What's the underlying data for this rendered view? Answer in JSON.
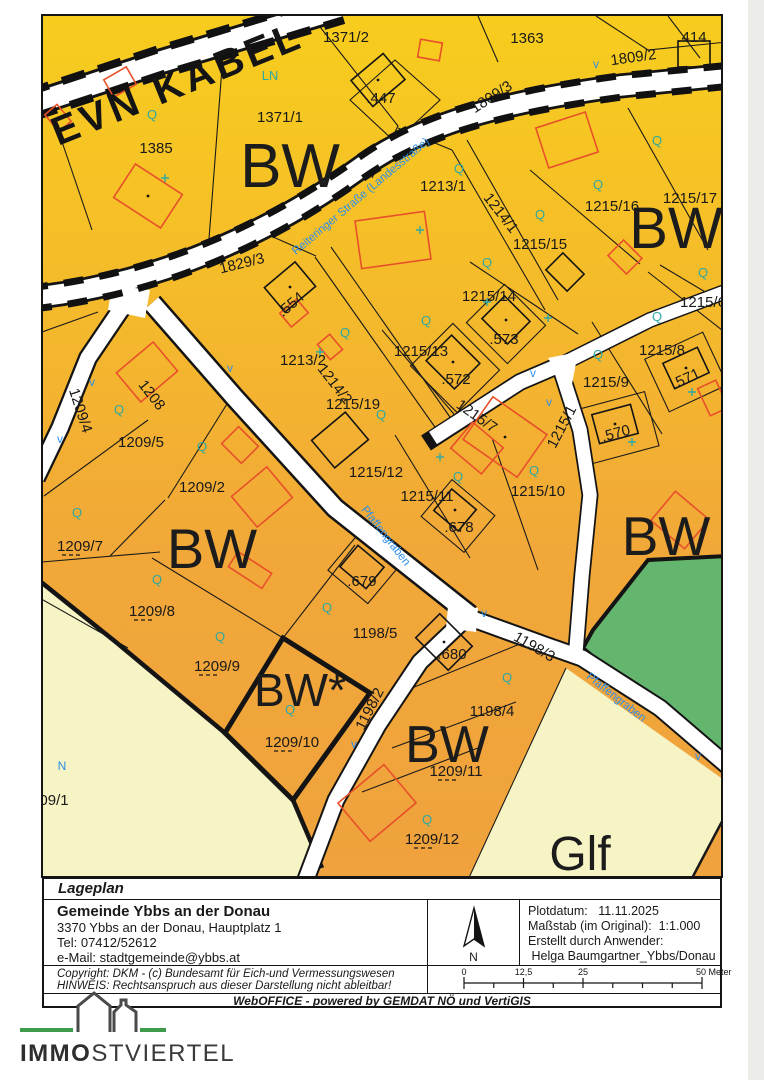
{
  "colors": {
    "zone_top": "#F7CD1D",
    "zone_mid": "#F3B42E",
    "zone_low": "#EFA23D",
    "zone_glf": "#F6F3C4",
    "zone_green": "#64B66E",
    "road_white": "#FFFFFF",
    "line_black": "#191919",
    "building_red": "#E8502A",
    "teal": "#2FA8A2",
    "blue": "#2E8FE8"
  },
  "map": {
    "cable_label": {
      "t": "EVN KABEL",
      "x": 182,
      "y": 96,
      "r": -22
    },
    "zone_labels": [
      {
        "t": "BW",
        "x": 290,
        "y": 187,
        "s": 62
      },
      {
        "t": "BW",
        "x": 676,
        "y": 248,
        "s": 58
      },
      {
        "t": "BW",
        "x": 212,
        "y": 568,
        "s": 56
      },
      {
        "t": "BW",
        "x": 666,
        "y": 555,
        "s": 55
      },
      {
        "t": "BW*",
        "x": 300,
        "y": 706,
        "s": 46
      },
      {
        "t": "BW",
        "x": 447,
        "y": 762,
        "s": 52
      },
      {
        "t": "Glf",
        "x": 580,
        "y": 870,
        "s": 48
      }
    ],
    "parcel_labels": [
      {
        "t": "1371/2",
        "x": 346,
        "y": 42
      },
      {
        "t": "1363",
        "x": 527,
        "y": 43
      },
      {
        "t": "1809/2",
        "x": 634,
        "y": 62,
        "r": -8
      },
      {
        "t": ".414",
        "x": 692,
        "y": 42
      },
      {
        "t": "1371/1",
        "x": 280,
        "y": 122
      },
      {
        "t": ".447",
        "x": 381,
        "y": 103
      },
      {
        "t": "1385",
        "x": 156,
        "y": 153
      },
      {
        "t": "1809/3",
        "x": 494,
        "y": 101,
        "r": -33
      },
      {
        "t": "1829/3",
        "x": 243,
        "y": 268,
        "r": -14
      },
      {
        "t": "1213/1",
        "x": 443,
        "y": 191
      },
      {
        "t": "1214/1",
        "x": 497,
        "y": 216,
        "r": 52
      },
      {
        "t": "1215/16",
        "x": 612,
        "y": 211
      },
      {
        "t": "1215/17",
        "x": 690,
        "y": 203
      },
      {
        "t": "1215/15",
        "x": 540,
        "y": 249
      },
      {
        "t": "1215/14",
        "x": 489,
        "y": 301
      },
      {
        "t": "1215/6",
        "x": 703,
        "y": 307
      },
      {
        "t": ".573",
        "x": 504,
        "y": 344
      },
      {
        "t": "1215/8",
        "x": 662,
        "y": 355
      },
      {
        "t": ".571",
        "x": 688,
        "y": 383,
        "r": -25
      },
      {
        "t": ".554",
        "x": 294,
        "y": 308,
        "r": -40
      },
      {
        "t": "1213/2",
        "x": 303,
        "y": 365
      },
      {
        "t": "1214/2",
        "x": 331,
        "y": 387,
        "r": 52
      },
      {
        "t": "1215/13",
        "x": 421,
        "y": 356
      },
      {
        "t": "1215/19",
        "x": 353,
        "y": 409
      },
      {
        "t": ".572",
        "x": 456,
        "y": 384
      },
      {
        "t": "1215/9",
        "x": 606,
        "y": 387
      },
      {
        "t": ".570",
        "x": 617,
        "y": 438,
        "r": -15
      },
      {
        "t": "1209/4",
        "x": 76,
        "y": 412,
        "r": 72
      },
      {
        "t": "1208",
        "x": 148,
        "y": 398,
        "r": 52
      },
      {
        "t": "1215/7",
        "x": 474,
        "y": 420,
        "r": 35
      },
      {
        "t": "1215/1",
        "x": 566,
        "y": 429,
        "r": -62
      },
      {
        "t": "1215/12",
        "x": 376,
        "y": 477
      },
      {
        "t": "1215/11",
        "x": 427,
        "y": 501
      },
      {
        "t": "1215/10",
        "x": 538,
        "y": 496
      },
      {
        "t": ".678",
        "x": 459,
        "y": 532
      },
      {
        "t": "1209/5",
        "x": 141,
        "y": 447
      },
      {
        "t": "1209/2",
        "x": 202,
        "y": 492
      },
      {
        "t": "1209/7",
        "x": 80,
        "y": 551,
        "u": 1
      },
      {
        "t": "1209/8",
        "x": 152,
        "y": 616,
        "u": 1
      },
      {
        "t": ".679",
        "x": 362,
        "y": 586
      },
      {
        "t": "1198/5",
        "x": 375,
        "y": 638
      },
      {
        "t": "1198/3",
        "x": 532,
        "y": 651,
        "r": 30
      },
      {
        "t": "1209/9",
        "x": 217,
        "y": 671,
        "u": 1
      },
      {
        "t": ".680",
        "x": 452,
        "y": 659
      },
      {
        "t": "1198/2",
        "x": 374,
        "y": 711,
        "r": -63
      },
      {
        "t": "1198/4",
        "x": 492,
        "y": 716
      },
      {
        "t": "1209/10",
        "x": 292,
        "y": 747,
        "u": 1
      },
      {
        "t": "1209/11",
        "x": 456,
        "y": 776,
        "u": 1
      },
      {
        "t": "1209/12",
        "x": 432,
        "y": 844,
        "u": 1
      },
      {
        "t": "09/1",
        "x": 54,
        "y": 805
      }
    ],
    "street_labels": [
      {
        "t": "Reiteringer Straße (Landesstraße)",
        "x": 363,
        "y": 199,
        "r": -40
      },
      {
        "t": "Pfaffengraben",
        "x": 383,
        "y": 538,
        "r": 52
      },
      {
        "t": "Pfaffengraben",
        "x": 614,
        "y": 700,
        "r": 38
      }
    ],
    "teal_labels": [
      {
        "t": "LN",
        "x": 270,
        "y": 80
      },
      {
        "t": "Q",
        "x": 152,
        "y": 119
      },
      {
        "t": "Q",
        "x": 657,
        "y": 145
      },
      {
        "t": "Q",
        "x": 598,
        "y": 189
      },
      {
        "t": "Q",
        "x": 459,
        "y": 173
      },
      {
        "t": "Q",
        "x": 540,
        "y": 219
      },
      {
        "t": "Q",
        "x": 487,
        "y": 267
      },
      {
        "t": "Q",
        "x": 345,
        "y": 337
      },
      {
        "t": "Q",
        "x": 426,
        "y": 325
      },
      {
        "t": "Q",
        "x": 381,
        "y": 419
      },
      {
        "t": "Q",
        "x": 458,
        "y": 481
      },
      {
        "t": "Q",
        "x": 534,
        "y": 475
      },
      {
        "t": "Q",
        "x": 119,
        "y": 414
      },
      {
        "t": "Q",
        "x": 202,
        "y": 451
      },
      {
        "t": "Q",
        "x": 77,
        "y": 517
      },
      {
        "t": "Q",
        "x": 157,
        "y": 584
      },
      {
        "t": "Q",
        "x": 220,
        "y": 641
      },
      {
        "t": "Q",
        "x": 327,
        "y": 612
      },
      {
        "t": "Q",
        "x": 290,
        "y": 714
      },
      {
        "t": "Q",
        "x": 507,
        "y": 682
      },
      {
        "t": "Q",
        "x": 427,
        "y": 824
      },
      {
        "t": "Q",
        "x": 657,
        "y": 321
      },
      {
        "t": "Q",
        "x": 598,
        "y": 359
      },
      {
        "t": "Q",
        "x": 703,
        "y": 277
      }
    ],
    "blue_labels": [
      {
        "t": "N",
        "x": 62,
        "y": 770
      },
      {
        "t": "v",
        "x": 596,
        "y": 68
      },
      {
        "t": "v",
        "x": 60,
        "y": 443
      },
      {
        "t": "v",
        "x": 92,
        "y": 386
      },
      {
        "t": "v",
        "x": 533,
        "y": 377
      },
      {
        "t": "v",
        "x": 549,
        "y": 406
      },
      {
        "t": "v",
        "x": 484,
        "y": 617
      },
      {
        "t": "v",
        "x": 354,
        "y": 748
      },
      {
        "t": "v",
        "x": 698,
        "y": 760
      },
      {
        "t": "v",
        "x": 230,
        "y": 372
      }
    ]
  },
  "info": {
    "title": "Lageplan",
    "org": "Gemeinde Ybbs an der Donau",
    "addr": "3370 Ybbs an der Donau, Hauptplatz 1",
    "tel": "Tel: 07412/52612",
    "mail": "e-Mail: stadtgemeinde@ybbs.at",
    "north": "N",
    "plot_label": "Plotdatum:",
    "plot_value": "11.11.2025",
    "scale_label": "Maßstab (im Original):",
    "scale_value": "1:1.000",
    "creator_label": "Erstellt durch Anwender:",
    "creator_value": "Helga Baumgartner_Ybbs/Donau",
    "copyright1": "Copyright: DKM - (c) Bundesamt für Eich-und Vermessungswesen",
    "copyright2": "HINWEIS: Rechtsanspruch aus dieser Darstellung nicht ableitbar!",
    "footer": "WebOFFICE - powered by GEMDAT NÖ und VertiGIS",
    "scalebar": {
      "t0": "0",
      "t1": "12,5",
      "t2": "25",
      "t3": "50 Meter"
    }
  },
  "logo": {
    "bold": "IMMO",
    "rest": "STVIERTEL"
  }
}
